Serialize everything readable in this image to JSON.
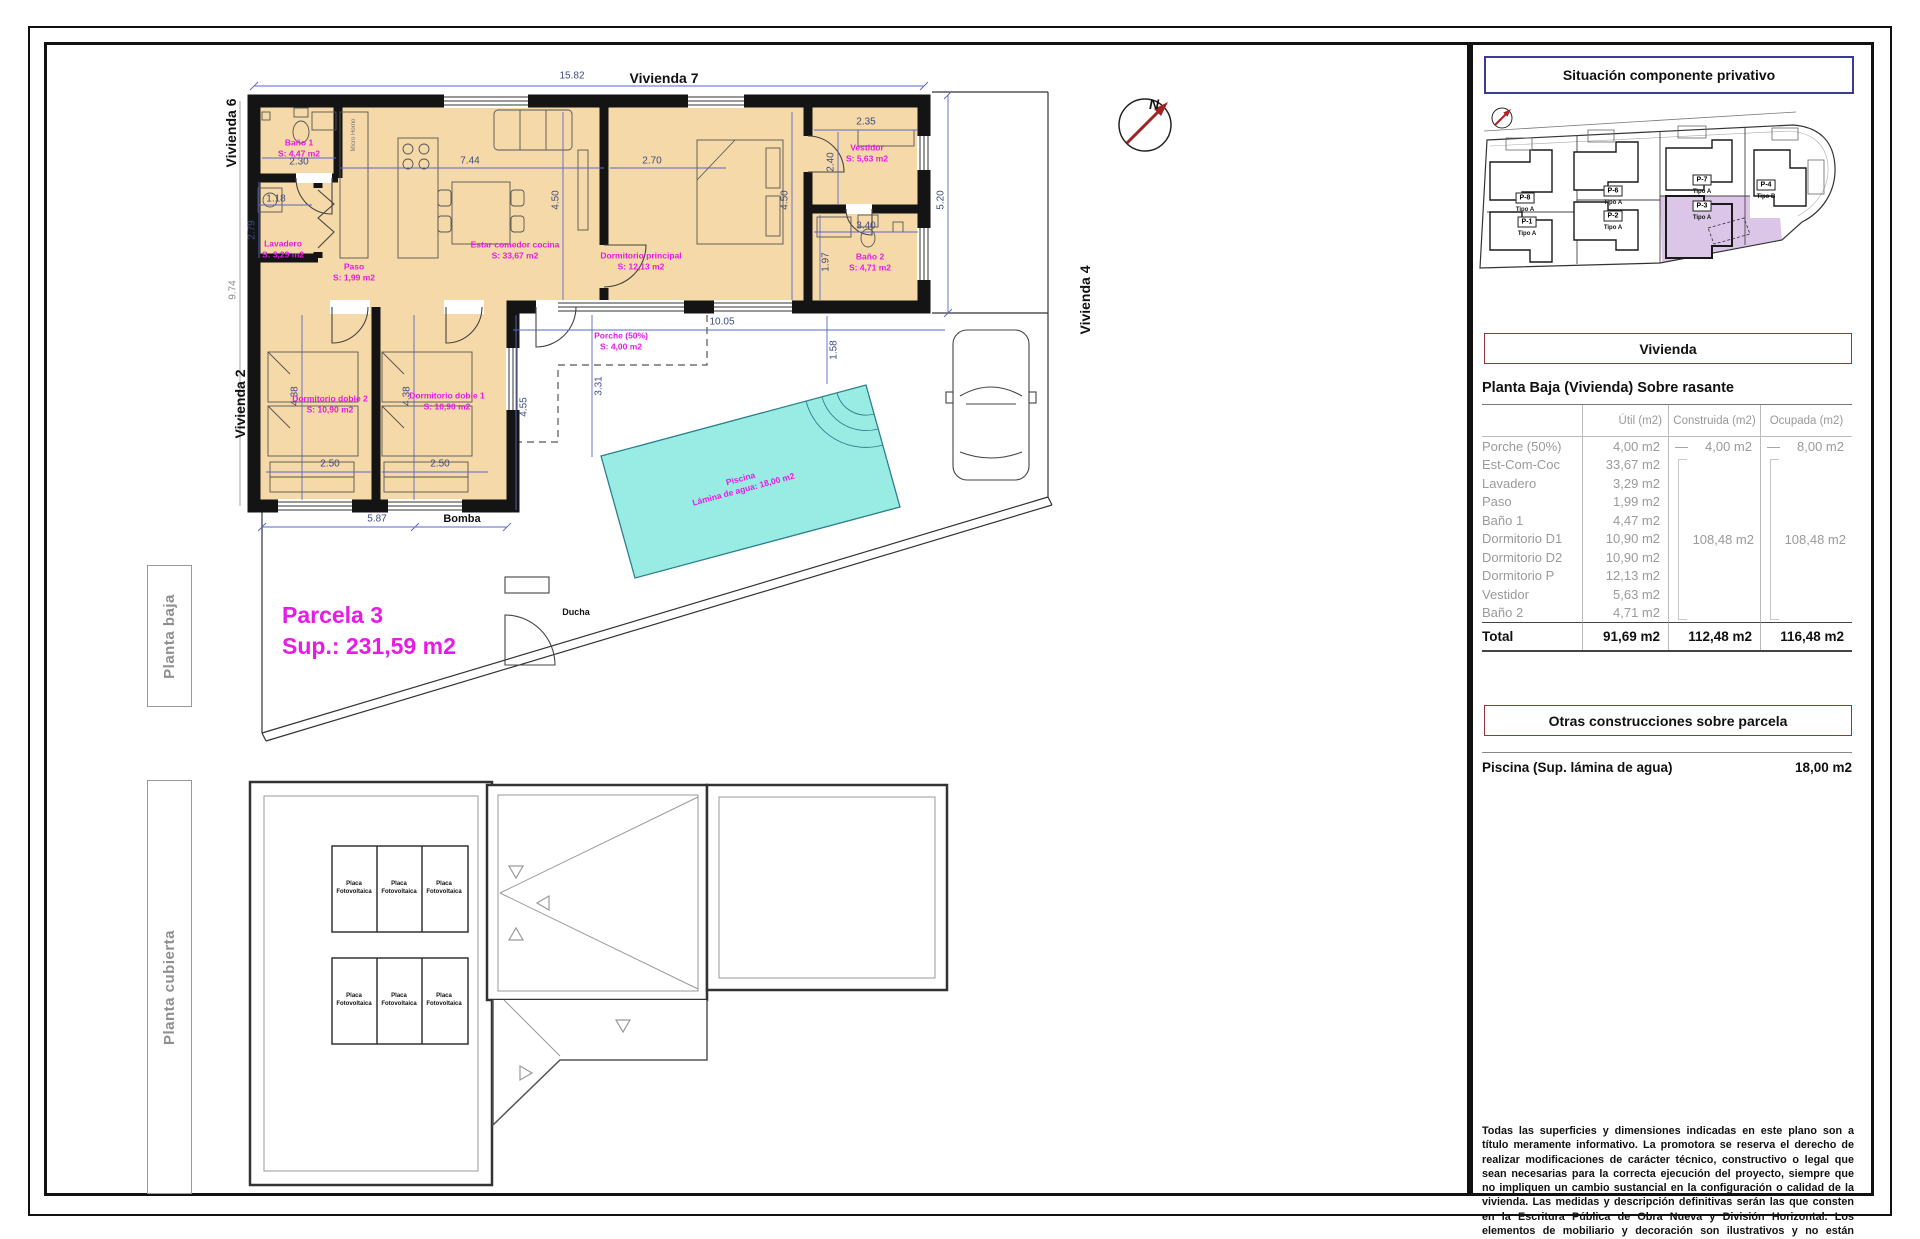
{
  "labels": {
    "planta_baja": "Planta baja",
    "planta_cubierta": "Planta cubierta",
    "vivienda7": "Vivienda 7",
    "vivienda6": "Vivienda 6",
    "vivienda2": "Vivienda 2",
    "vivienda4": "Vivienda 4",
    "parcela_title": "Parcela 3",
    "parcela_sup": "Sup.: 231,59 m2",
    "bomba": "Bomba",
    "ducha": "Ducha",
    "north": "N",
    "micro": "Micro Horno",
    "placa_line1": "Placa",
    "placa_line2": "Fotovoltaica"
  },
  "pool": {
    "line1": "Piscina",
    "line2": "Lámina de agua: 18,00 m2"
  },
  "rooms": [
    {
      "name": "Baño 1",
      "area": "S: 4,47 m2"
    },
    {
      "name": "Lavadero",
      "area": "S: 3,29 m2"
    },
    {
      "name": "Paso",
      "area": "S: 1,99 m2"
    },
    {
      "name": "Estar comedor cocina",
      "area": "S: 33,67 m2"
    },
    {
      "name": "Dormitorio principal",
      "area": "S: 12,13 m2"
    },
    {
      "name": "Vestidor",
      "area": "S: 5,63 m2"
    },
    {
      "name": "Baño 2",
      "area": "S: 4,71 m2"
    },
    {
      "name": "Dormitorio doble 2",
      "area": "S: 10,90 m2"
    },
    {
      "name": "Dormitorio doble 1",
      "area": "S: 10,90 m2"
    },
    {
      "name": "Porche (50%)",
      "area": "S: 4,00 m2"
    }
  ],
  "dims": {
    "top": "15.82",
    "bano1": "2.30",
    "lav_w": "1.18",
    "lav_h": "2.79",
    "left": "9.74",
    "estar_w": "7.44",
    "estar_h": "4.50",
    "dormp_w": "2.70",
    "dormp_h": "4.50",
    "vest_w": "2.35",
    "vest_h": "2.40",
    "bano2_w": "3.40",
    "bano2_h": "1.97",
    "right": "5.20",
    "porche_w": "10.05",
    "porche_h": "3.31",
    "wing": "4.55",
    "dd2_h": "4.38",
    "dd1_h": "4.38",
    "dd2_w": "2.50",
    "dd1_w": "2.50",
    "bottom": "5.87",
    "pool": "1.58"
  },
  "sitemap": {
    "parcels": [
      {
        "id": "P-8",
        "tipo": "Tipo A"
      },
      {
        "id": "P-1",
        "tipo": "Tipo A"
      },
      {
        "id": "P-6",
        "tipo": "Tipo A"
      },
      {
        "id": "P-2",
        "tipo": "Tipo A"
      },
      {
        "id": "P-7",
        "tipo": "Tipo A"
      },
      {
        "id": "P-3",
        "tipo": "Tipo A"
      },
      {
        "id": "P-4",
        "tipo": "Tipo B"
      }
    ]
  },
  "sidebar": {
    "situacion_title": "Situación componente privativo",
    "vivienda_title": "Vivienda",
    "planta_baja_title": "Planta Baja (Vivienda) Sobre rasante",
    "table": {
      "col_util": "Útil (m2)",
      "col_construida": "Construida (m2)",
      "col_ocupada": "Ocupada (m2)",
      "dash": "—",
      "rows": [
        {
          "label": "Porche (50%)",
          "util": "4,00 m2"
        },
        {
          "label": "Est-Com-Coc",
          "util": "33,67 m2"
        },
        {
          "label": "Lavadero",
          "util": "3,29 m2"
        },
        {
          "label": "Paso",
          "util": "1,99 m2"
        },
        {
          "label": "Baño 1",
          "util": "4,47 m2"
        },
        {
          "label": "Dormitorio D1",
          "util": "10,90 m2"
        },
        {
          "label": "Dormitorio D2",
          "util": "10,90 m2"
        },
        {
          "label": "Dormitorio P",
          "util": "12,13 m2"
        },
        {
          "label": "Vestidor",
          "util": "5,63 m2"
        },
        {
          "label": "Baño 2",
          "util": "4,71 m2"
        }
      ],
      "porche_construida": "4,00 m2",
      "porche_ocupada": "8,00 m2",
      "group_construida": "108,48 m2",
      "group_ocupada": "108,48 m2",
      "total_label": "Total",
      "total_util": "91,69 m2",
      "total_construida": "112,48 m2",
      "total_ocupada": "116,48 m2"
    },
    "otras_title": "Otras construcciones sobre parcela",
    "piscina_label": "Piscina (Sup. lámina de agua)",
    "piscina_value": "18,00 m2",
    "disclaimer": "Todas las superficies y dimensiones indicadas en este plano son a título meramente informativo. La promotora se reserva el derecho de realizar modificaciones de carácter técnico, constructivo o legal que sean necesarias para la correcta ejecución del proyecto, siempre que no impliquen un cambio sustancial en la configuración o calidad de la vivienda. Las medidas y descripción definitivas serán las que consten en la Escritura Pública de Obra Nueva y División Horizontal. Los elementos de mobiliario y decoración son ilustrativos y no están incluidos."
  }
}
